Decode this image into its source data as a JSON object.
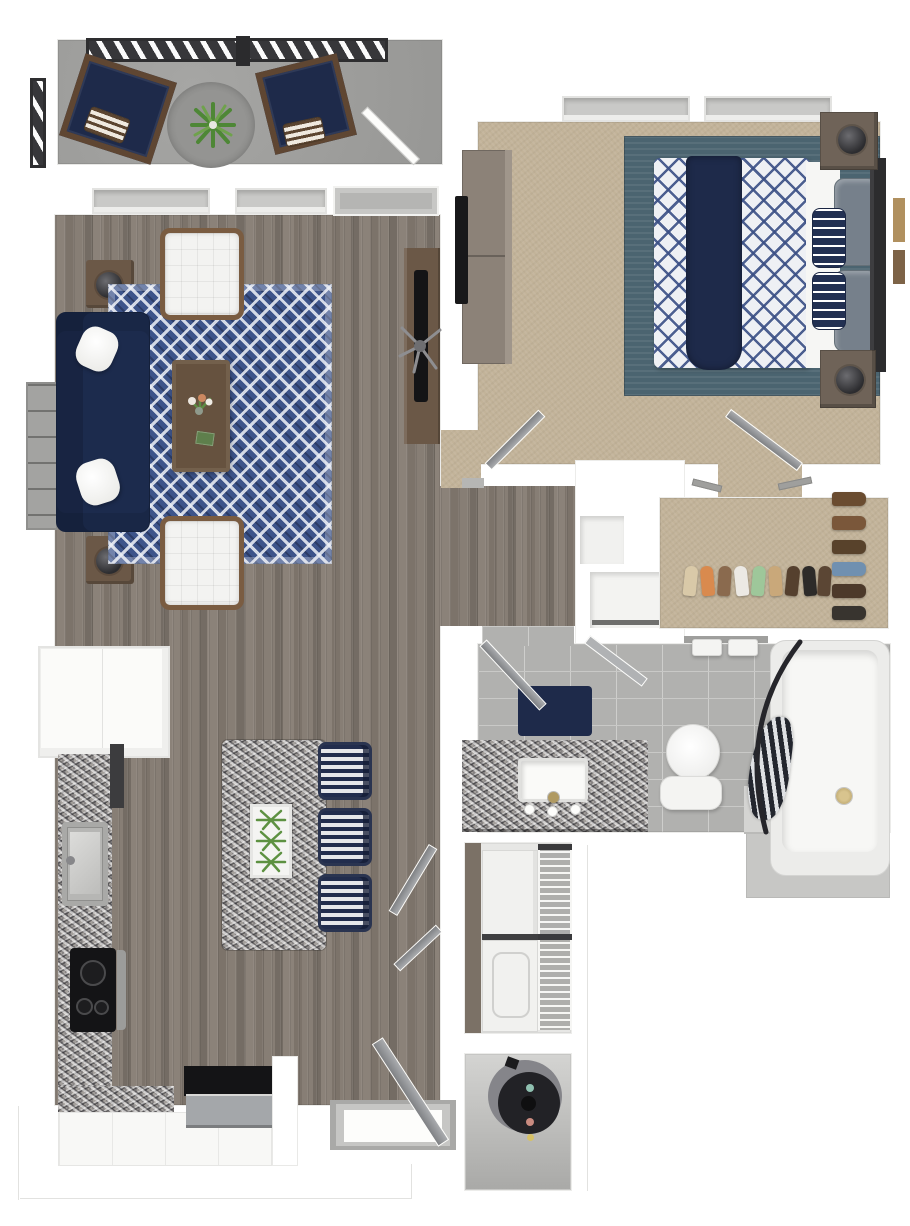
{
  "title": "3D apartment floor plan — one bedroom, one bathroom with balcony",
  "palette": {
    "navy": "#1e2a4a",
    "sofa": "#1c2b4d",
    "rug_blue": "#3d548a",
    "teal_rug": "#4b6470",
    "carpet": "#c2b399",
    "wood_floor": "#847b72",
    "concrete": "#979795",
    "outdoor_rug": "#8b8b89",
    "tile": "#b1b1af",
    "granite": "#a39f9b",
    "wood_brown": "#6b5847",
    "wood_dark": "#66523f",
    "chair_wood": "#5f4632",
    "chair_wood2": "#7a5c41",
    "railing": "#37373a",
    "window": "#c9c9c7",
    "gray_pillow": "#76808b",
    "black": "#141416",
    "stainless": "#a4a7aa",
    "brass": "#b09a62",
    "appliance_white": "#f1f1ef",
    "heater_dark": "#222226",
    "heater_gray": "#85858a",
    "leaf_green": "#4e8736",
    "leaf_green_light": "#6fa24c"
  },
  "rooms": [
    {
      "name": "Balcony",
      "items": [
        "railing",
        "lounge chair",
        "lounge chair",
        "striped pillows",
        "round outdoor rug",
        "potted plant",
        "balcony door"
      ]
    },
    {
      "name": "Living Room",
      "items": [
        "navy sofa",
        "white throw pillows",
        "diamond pattern area rug",
        "white tufted armchair",
        "white tufted armchair",
        "wood coffee table with flowers and book",
        "side table with lamp",
        "side table with lamp",
        "bookshelf",
        "desk",
        "monitor",
        "office chair",
        "two windows"
      ]
    },
    {
      "name": "Kitchen",
      "items": [
        "upper cabinets",
        "granite counters",
        "sink",
        "dishwasher",
        "black cooktop",
        "refrigerator",
        "granite island",
        "plant tray",
        "bar stool",
        "bar stool",
        "bar stool"
      ]
    },
    {
      "name": "Bedroom",
      "items": [
        "bed with navy diamond duvet",
        "teal area rug",
        "dresser",
        "tv",
        "nightstand with lamp",
        "nightstand with lamp",
        "headboard",
        "gray pillows",
        "navy striped pillows",
        "two windows",
        "wall art"
      ]
    },
    {
      "name": "Walk-in Closet",
      "items": [
        "hanging rods",
        "shoe rows"
      ]
    },
    {
      "name": "Bathroom",
      "items": [
        "granite vanity",
        "sink",
        "faucet",
        "navy bath mat",
        "toilet",
        "towel bar with towels",
        "bathtub",
        "striped shower curtain",
        "curved curtain rod"
      ]
    },
    {
      "name": "Laundry Closet",
      "items": [
        "stacked washer and dryer",
        "wire shelving"
      ]
    },
    {
      "name": "Utility Closet",
      "items": [
        "water heater"
      ]
    },
    {
      "name": "Entry",
      "items": [
        "front door",
        "threshold"
      ]
    }
  ],
  "closet": {
    "shoes_bottom": [
      "#d9c9a8",
      "#d98a4e",
      "#8a6a4e",
      "#ece9e4",
      "#9ec79a",
      "#c9a87a",
      "#55402e",
      "#2d2b29",
      "#5b4634"
    ],
    "shoes_right": [
      "#6a4c30",
      "#7a573a",
      "#58422b",
      "#7090b0",
      "#4c392a",
      "#38342f"
    ]
  }
}
